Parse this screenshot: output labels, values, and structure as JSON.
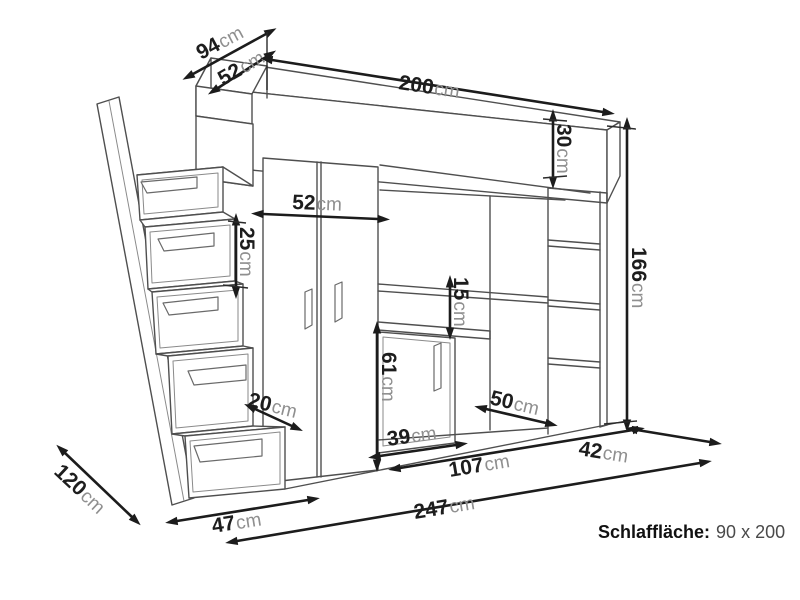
{
  "diagram": {
    "kind": "furniture-dimension-drawing",
    "background": "#ffffff",
    "line_color": "#4f4f4f",
    "dimension_color": "#1c1c1c",
    "unit_text_color": "#8f8f8f"
  },
  "dimensions": [
    {
      "id": "head-top-depth",
      "value": "94",
      "unit": "cm"
    },
    {
      "id": "head-shelf-depth",
      "value": "52",
      "unit": "cm"
    },
    {
      "id": "bed-length",
      "value": "200",
      "unit": "cm"
    },
    {
      "id": "bed-frame-height",
      "value": "30",
      "unit": "cm"
    },
    {
      "id": "total-height",
      "value": "166",
      "unit": "cm"
    },
    {
      "id": "wardrobe-width",
      "value": "52",
      "unit": "cm"
    },
    {
      "id": "stair-drawer-height",
      "value": "25",
      "unit": "cm"
    },
    {
      "id": "shelf-desk-gap",
      "value": "15",
      "unit": "cm"
    },
    {
      "id": "desk-height",
      "value": "61",
      "unit": "cm"
    },
    {
      "id": "cabinet-width",
      "value": "39",
      "unit": "cm"
    },
    {
      "id": "niche-floor-depth",
      "value": "50",
      "unit": "cm"
    },
    {
      "id": "step-tread-depth",
      "value": "20",
      "unit": "cm"
    },
    {
      "id": "bottom-step-width",
      "value": "47",
      "unit": "cm"
    },
    {
      "id": "open-section-width",
      "value": "107",
      "unit": "cm"
    },
    {
      "id": "unit-depth-right",
      "value": "42",
      "unit": "cm"
    },
    {
      "id": "total-width",
      "value": "247",
      "unit": "cm"
    },
    {
      "id": "side-depth",
      "value": "120",
      "unit": "cm"
    }
  ],
  "note": {
    "label": "Schlaffläche:",
    "value": "90 x 200"
  }
}
